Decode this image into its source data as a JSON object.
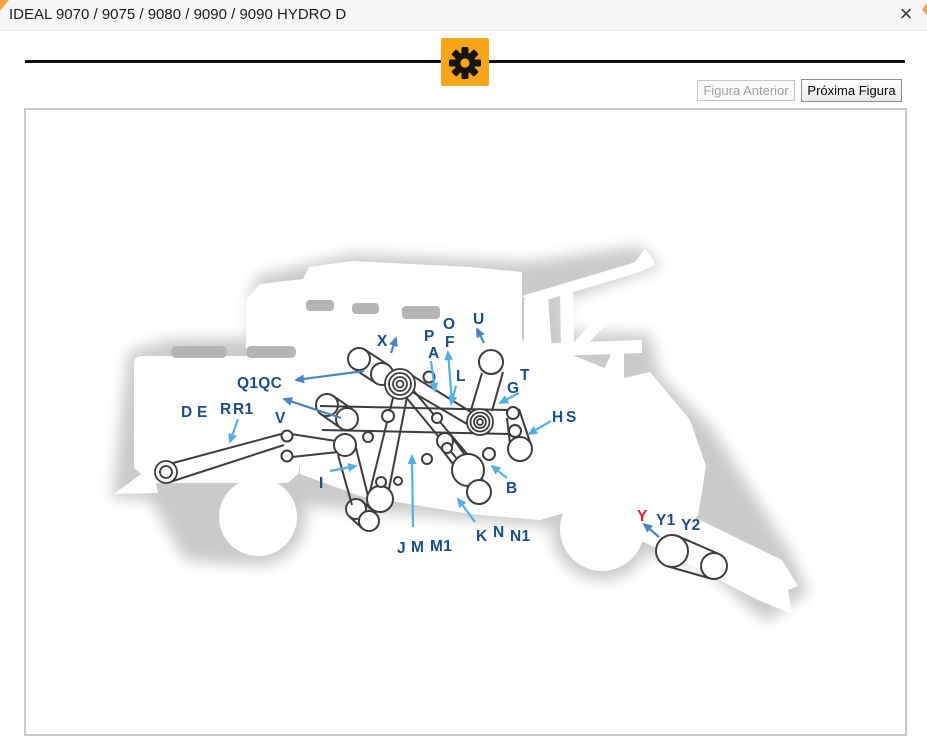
{
  "window": {
    "title": "IDEAL 9070 / 9075 / 9080 / 9090 / 9090 HYDRO D",
    "close_glyph": "×"
  },
  "toolbar": {
    "accent_color": "#F9A51B",
    "gear_icon": "gear"
  },
  "nav": {
    "prev_label": "Figura Anterior",
    "next_label": "Próxima Figura",
    "prev_enabled": false,
    "next_enabled": true
  },
  "diagram": {
    "line_color": "#3c3c3c",
    "label_color": "#1a4e8a",
    "highlight_color": "#e02020",
    "arrow_light": "#54b0e2",
    "arrow_medium": "#4a84c4",
    "labels": [
      {
        "t": "X",
        "x": 377,
        "y": 346
      },
      {
        "t": "P",
        "x": 424,
        "y": 341
      },
      {
        "t": "A",
        "x": 428,
        "y": 358
      },
      {
        "t": "O",
        "x": 443,
        "y": 329
      },
      {
        "t": "F",
        "x": 445,
        "y": 347
      },
      {
        "t": "U",
        "x": 473,
        "y": 324
      },
      {
        "t": "L",
        "x": 456,
        "y": 381
      },
      {
        "t": "G",
        "x": 507,
        "y": 393
      },
      {
        "t": "T",
        "x": 520,
        "y": 380
      },
      {
        "t": "Q1QC",
        "x": 237,
        "y": 388
      },
      {
        "t": "V",
        "x": 275,
        "y": 423
      },
      {
        "t": "D",
        "x": 181,
        "y": 417
      },
      {
        "t": "E",
        "x": 197,
        "y": 417
      },
      {
        "t": "R",
        "x": 220,
        "y": 414
      },
      {
        "t": "R1",
        "x": 233,
        "y": 414
      },
      {
        "t": "H",
        "x": 552,
        "y": 422
      },
      {
        "t": "S",
        "x": 566,
        "y": 422
      },
      {
        "t": "I",
        "x": 319,
        "y": 488
      },
      {
        "t": "B",
        "x": 506,
        "y": 493
      },
      {
        "t": "K",
        "x": 476,
        "y": 541
      },
      {
        "t": "N",
        "x": 493,
        "y": 537
      },
      {
        "t": "N1",
        "x": 510,
        "y": 541
      },
      {
        "t": "J",
        "x": 397,
        "y": 553
      },
      {
        "t": "M",
        "x": 411,
        "y": 552
      },
      {
        "t": "M1",
        "x": 430,
        "y": 551
      },
      {
        "t": "Y",
        "x": 637,
        "y": 521,
        "c": "#e02020"
      },
      {
        "t": "Y1",
        "x": 656,
        "y": 525
      },
      {
        "t": "Y2",
        "x": 681,
        "y": 530
      }
    ],
    "arrows": [
      {
        "x1": 391,
        "y1": 353,
        "x2": 396,
        "y2": 338,
        "c": "m"
      },
      {
        "x1": 431,
        "y1": 361,
        "x2": 435,
        "y2": 391,
        "c": "l"
      },
      {
        "x1": 452,
        "y1": 402,
        "x2": 448,
        "y2": 352,
        "c": "l"
      },
      {
        "x1": 456,
        "y1": 386,
        "x2": 451,
        "y2": 404,
        "c": "l"
      },
      {
        "x1": 484,
        "y1": 343,
        "x2": 477,
        "y2": 329,
        "c": "m"
      },
      {
        "x1": 519,
        "y1": 393,
        "x2": 500,
        "y2": 403,
        "c": "l"
      },
      {
        "x1": 364,
        "y1": 371,
        "x2": 296,
        "y2": 380,
        "c": "m"
      },
      {
        "x1": 341,
        "y1": 418,
        "x2": 284,
        "y2": 399,
        "c": "m"
      },
      {
        "x1": 238,
        "y1": 419,
        "x2": 230,
        "y2": 442,
        "c": "l"
      },
      {
        "x1": 551,
        "y1": 421,
        "x2": 529,
        "y2": 434,
        "c": "l"
      },
      {
        "x1": 330,
        "y1": 471,
        "x2": 356,
        "y2": 466,
        "c": "l"
      },
      {
        "x1": 507,
        "y1": 478,
        "x2": 492,
        "y2": 466,
        "c": "l"
      },
      {
        "x1": 475,
        "y1": 522,
        "x2": 458,
        "y2": 499,
        "c": "l"
      },
      {
        "x1": 413,
        "y1": 527,
        "x2": 412,
        "y2": 456,
        "c": "l"
      },
      {
        "x1": 659,
        "y1": 537,
        "x2": 644,
        "y2": 524,
        "c": "m"
      }
    ],
    "belts": [
      [
        162,
        466,
        281,
        434
      ],
      [
        170,
        482,
        284,
        445
      ],
      [
        291,
        434,
        336,
        441
      ],
      [
        292,
        457,
        338,
        452
      ],
      [
        320,
        406,
        508,
        410
      ],
      [
        322,
        430,
        509,
        434
      ],
      [
        408,
        373,
        471,
        412
      ],
      [
        397,
        383,
        467,
        424
      ],
      [
        393,
        398,
        370,
        491
      ],
      [
        407,
        397,
        389,
        489
      ],
      [
        405,
        396,
        457,
        459
      ],
      [
        413,
        390,
        468,
        455
      ],
      [
        482,
        373,
        471,
        410
      ],
      [
        503,
        372,
        492,
        411
      ],
      [
        507,
        418,
        510,
        444
      ],
      [
        519,
        409,
        530,
        442
      ],
      [
        440,
        447,
        469,
        485
      ],
      [
        452,
        437,
        487,
        486
      ],
      [
        338,
        455,
        352,
        505
      ],
      [
        356,
        448,
        371,
        508
      ]
    ],
    "pulleys": [
      [
        429,
        377,
        5.5
      ],
      [
        437,
        418,
        5
      ],
      [
        445,
        441,
        8
      ],
      [
        388,
        416,
        6
      ],
      [
        368,
        437,
        5
      ],
      [
        345,
        445,
        11
      ],
      [
        513,
        413,
        6
      ],
      [
        515,
        431,
        6
      ],
      [
        520,
        449,
        12
      ],
      [
        468,
        470,
        16
      ],
      [
        479,
        492,
        12
      ],
      [
        489,
        454,
        6
      ],
      [
        427,
        459,
        5
      ],
      [
        447,
        448,
        5
      ],
      [
        380,
        499,
        13
      ],
      [
        381,
        482,
        5
      ],
      [
        398,
        481,
        4
      ],
      [
        287,
        436,
        5.5
      ],
      [
        287,
        456,
        5.5
      ],
      [
        491,
        362,
        12
      ]
    ],
    "rings": [
      {
        "cx": 400,
        "cy": 384,
        "rr": [
          15,
          11,
          7,
          3.5
        ]
      },
      {
        "cx": 480,
        "cy": 422,
        "rr": [
          13,
          9.5,
          6,
          3
        ]
      },
      {
        "cx": 166,
        "cy": 472,
        "rr": [
          11,
          6
        ]
      }
    ],
    "capsules": [
      {
        "x1": 359,
        "y1": 359,
        "x2": 382,
        "y2": 374,
        "r1": 11,
        "r2": 11
      },
      {
        "x1": 327,
        "y1": 405,
        "x2": 347,
        "y2": 419,
        "r1": 11,
        "r2": 11
      },
      {
        "x1": 356,
        "y1": 509,
        "x2": 369,
        "y2": 521,
        "r1": 10,
        "r2": 10
      },
      {
        "x1": 672,
        "y1": 551,
        "x2": 714,
        "y2": 566,
        "r1": 16,
        "r2": 13
      }
    ]
  }
}
